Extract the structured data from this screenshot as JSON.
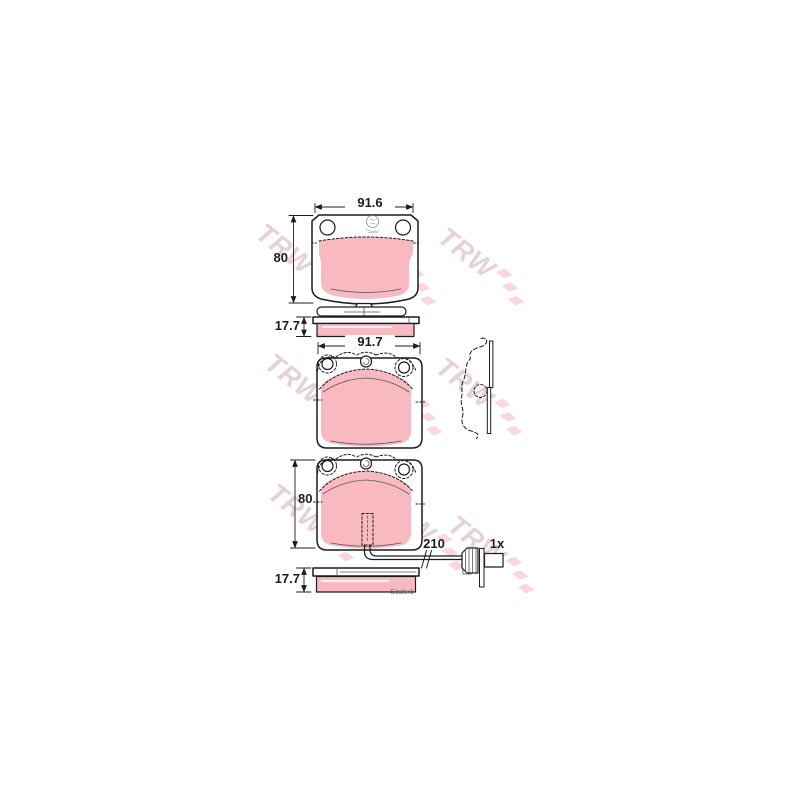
{
  "watermark": {
    "text": "TRW"
  },
  "labels": {
    "pad1_width": "91.6",
    "pad1_height": "80",
    "side1_thickness": "17.7",
    "pad2_width": "91.7",
    "pad3_height": "80",
    "sensor_wire_length": "210",
    "sensor_quantity": "1x",
    "side2_thickness": "17.7",
    "scale_note": "Scale:1"
  },
  "colors": {
    "pad_pink": "#f9b9c0",
    "outline": "#1c1c1c",
    "watermark_text": "#cfa7ae",
    "watermark_flag": "#ef9aa8"
  }
}
